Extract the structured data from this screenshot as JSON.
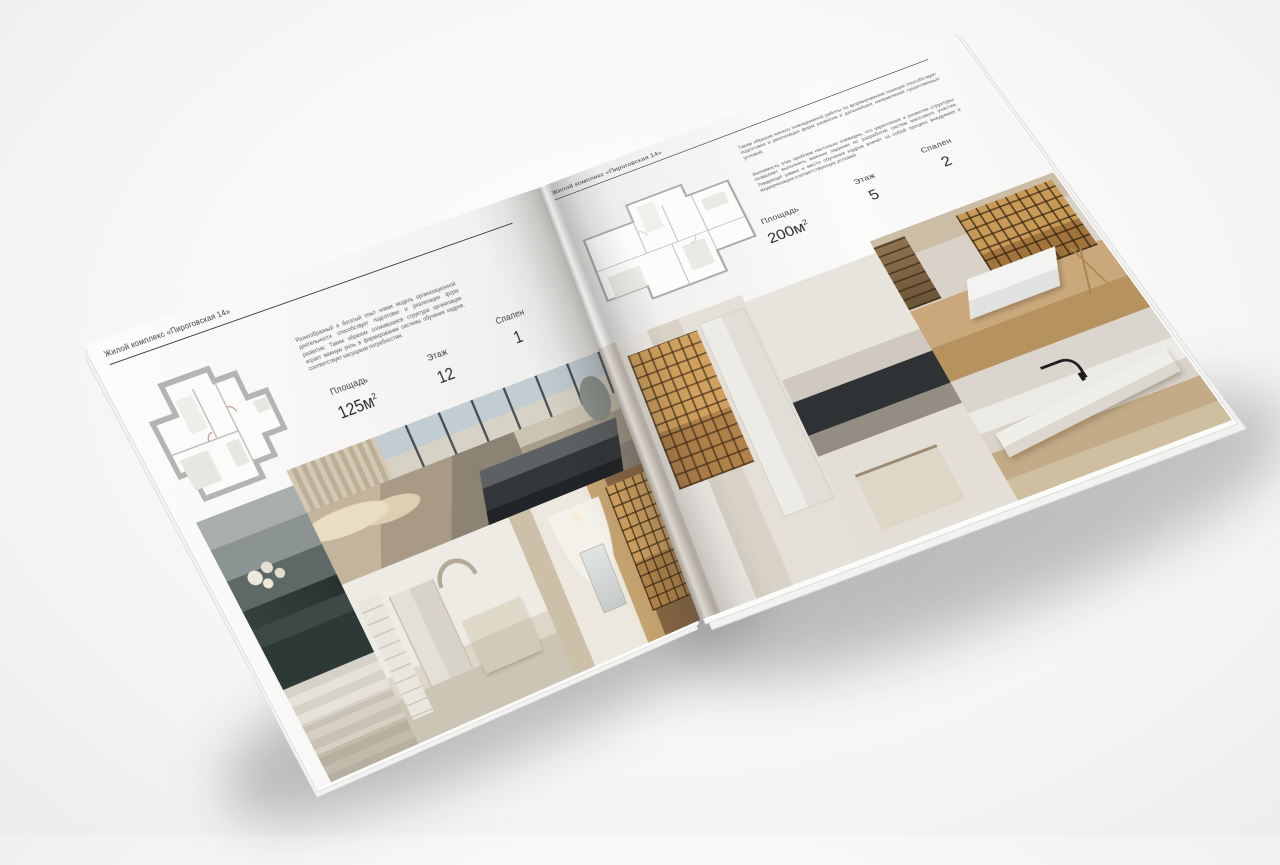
{
  "pages": {
    "left": {
      "header": "Жилой комплекс «Пироговская 14»",
      "description": "Разнообразный и богатый опыт новая модель организационной деятельности способствует подготовке и реализации форм развития. Таким образом сложившаяся структура организации играет важную роль в формировании системы обучения кадров, соответствует насущным потребностям.",
      "stats": [
        {
          "label": "Площадь",
          "value": "125м",
          "sup": "2"
        },
        {
          "label": "Этаж",
          "value": "12",
          "sup": ""
        },
        {
          "label": "Спален",
          "value": "1",
          "sup": ""
        }
      ]
    },
    "right": {
      "header": "Жилой комплекс «Пироговская 14»",
      "paragraph_1": "Таким образом начало повседневной работы по формированию позиции способствует подготовке и реализации форм развития и дальнейших направлений существенных условий.",
      "paragraph_2": "Значимость этих проблем настолько очевидна, что укрепление и развитие структуры позволяет выполнять важные задания по разработке систем массового участия. Товарищи! рамки и место обучения кадров влечёт за собой процесс внедрения и модернизации соответствующих условий.",
      "stats": [
        {
          "label": "Площадь",
          "value": "200м",
          "sup": "2"
        },
        {
          "label": "Этаж",
          "value": "5",
          "sup": ""
        },
        {
          "label": "Спален",
          "value": "2",
          "sup": ""
        }
      ]
    }
  },
  "colors": {
    "page": "#f7f6f4",
    "text_dark": "#3a3a3a",
    "text_muted": "#5c5c5c",
    "plan_wall": "#b4b4b2",
    "shelf_amber": "#c79a5a"
  }
}
